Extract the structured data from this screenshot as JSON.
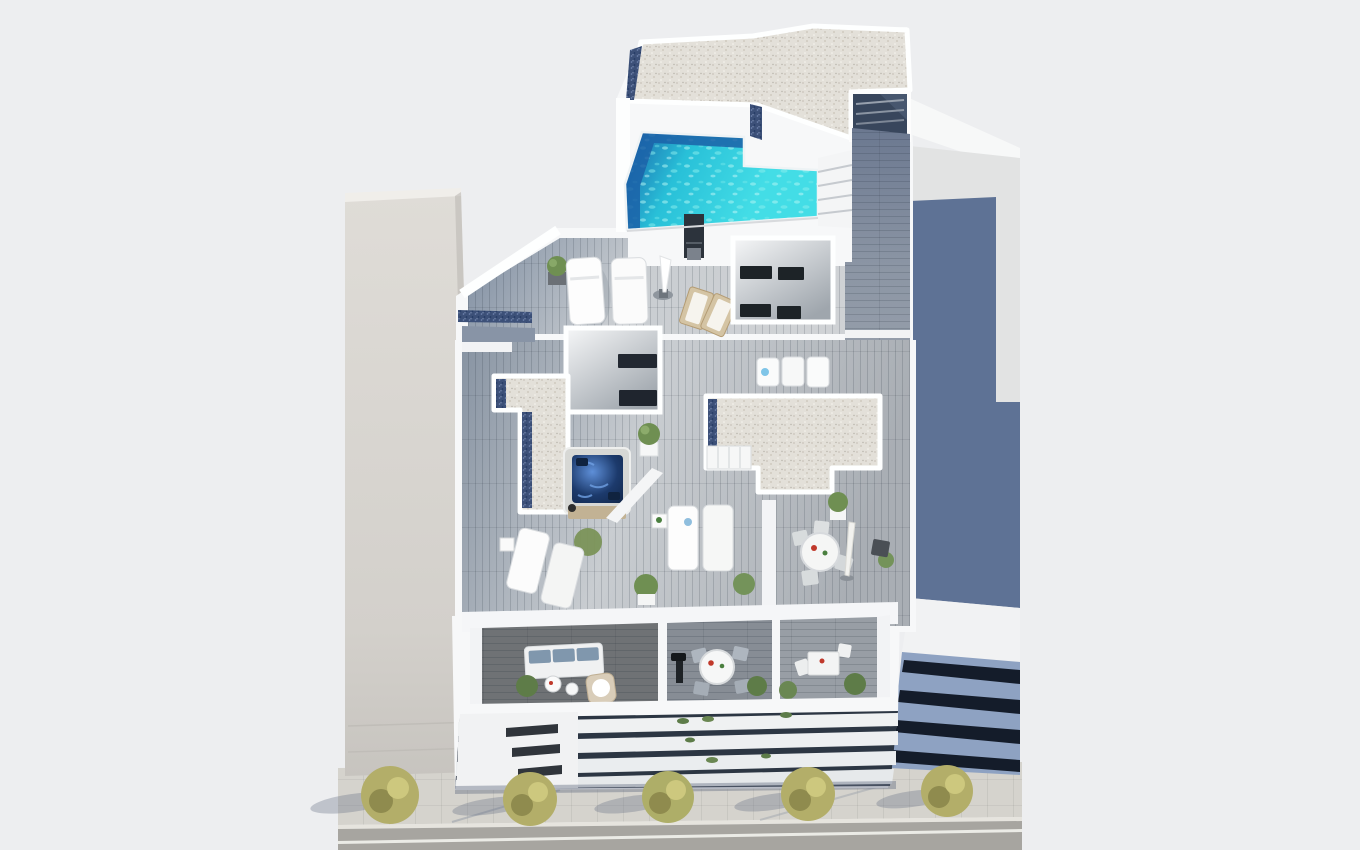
{
  "scene": {
    "type": "3d-architectural-render",
    "view": "aerial-top-down",
    "subject": "residential building rooftop solarium with pool, jacuzzi and terraces, street with trees at bottom"
  },
  "inventory": {
    "street_trees": 5,
    "front_balconies": 3,
    "facade_glass_bands": 3,
    "pools": 1,
    "jacuzzis": 1,
    "sun_loungers_large": 6,
    "sun_loungers_small": 3,
    "wooden_deck_chairs": 2,
    "dining_tables_round": 2,
    "dining_tables_square": 1,
    "sofas": 1,
    "umbrellas": 2,
    "outdoor_showers": 1
  },
  "colors": {
    "background": "#edeef0",
    "white_wall": "#f7f8f9",
    "bright_white": "#feffff",
    "gravel_base": "#e3e0d9",
    "pebble_blue": "#3c5078",
    "pool_deep": "#1b61a8",
    "pool_mid": "#28c0d8",
    "pool_turquoise": "#43dde6",
    "pool_ripple": "#aef4f2",
    "jacuzzi_water": "#1c3a6c",
    "jacuzzi_ripple": "#5e8fd8",
    "jacuzzi_wood": "#c2b294",
    "deck_dark": "#7d8ca0",
    "deck_light": "#c9cdd1",
    "deck_mid": "#a9aeb4",
    "walkway_slate": "#6b7890",
    "atrium_wall": "#9fa6ad",
    "window_dark": "#1d2327",
    "shower_dark": "#2c333c",
    "furniture_white": "#fbfcfc",
    "furniture_wood": "#d4c4a4",
    "chair_gray": "#aeb6bf",
    "sofa_cushion": "#8097ad",
    "plant_green": "#6f8f52",
    "plant_dark": "#4e6b3a",
    "balcony_floor_dark": "#6f7275",
    "balcony_floor_mid": "#878d95",
    "balcony_floor_light": "#989ea5",
    "facade_dark": "#2c3643",
    "slab_white": "#eff1f2",
    "left_building_light": "#dfdcd7",
    "left_building_dark": "#c7c4bf",
    "right_roof_lit": "#e2e3e3",
    "right_roof_shadow": "#5e7295",
    "right_facade_blue": "#8ea2c2",
    "right_facade_glass": "#141c2a",
    "sidewalk": "#d5d3cd",
    "curb": "#e6e4de",
    "road": "#a7a5a0",
    "road_line": "#ebebe6",
    "tree_green": "#b3ae69",
    "tree_highlight": "#cdc87e",
    "tree_dark": "#8f8b4e",
    "shadow_soft": "#6a7488",
    "item_red": "#c0392b",
    "item_green": "#4a7f3f"
  }
}
